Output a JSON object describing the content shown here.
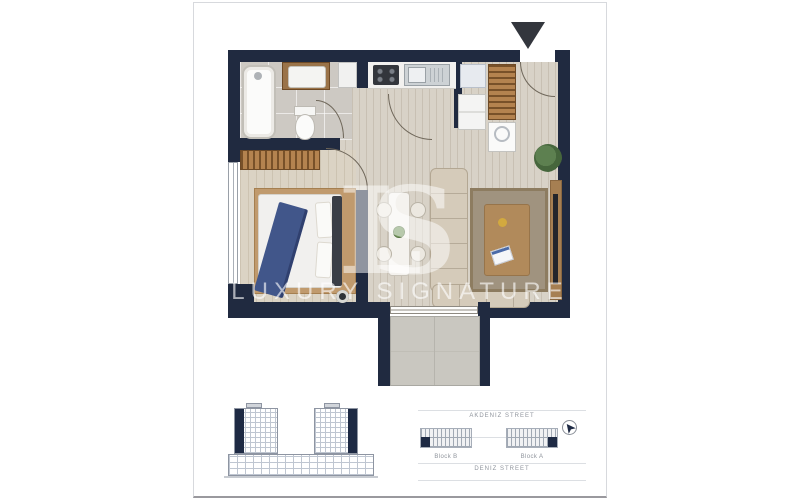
{
  "watermark": {
    "logo": "LS",
    "text": "LUXURY SIGNATURE"
  },
  "site_plan": {
    "street_top": "AKDENIZ STREET",
    "street_bottom": "DENIZ STREET",
    "block_b": "Block B",
    "block_a": "Block A"
  },
  "icons": {
    "north_arrow": "solid-down-triangle",
    "compass": "north-arrow-in-circle"
  },
  "colors": {
    "wall_navy": "#202a40",
    "navy_accent": "#1e2a44",
    "wood_floor": "#d8d2c7",
    "tile_floor": "#cdc9c3",
    "closet_wood": "#b4834f",
    "sofa_beige": "#d5cbba",
    "bed_throw_blue": "#41568a",
    "living_rug": "#a0937f",
    "bedroom_rug": "#c09a6d",
    "frame_border": "#d7d9dd",
    "watermark_white": "rgba(255,255,255,0.6)"
  }
}
